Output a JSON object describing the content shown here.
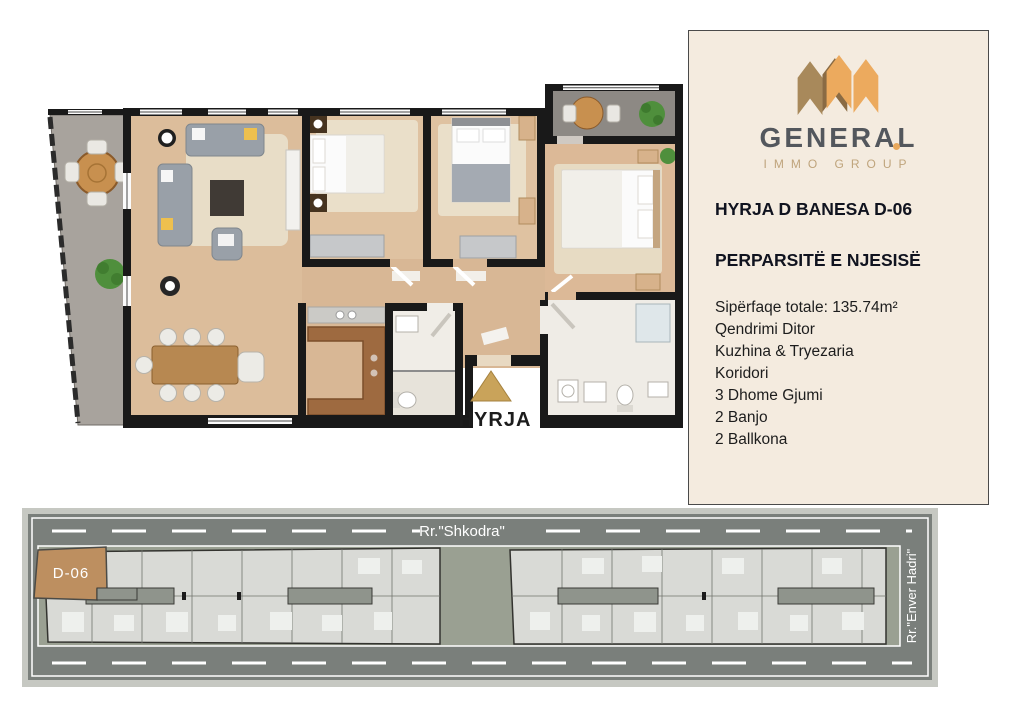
{
  "window": {
    "width": 1013,
    "height": 717,
    "background": "#ffffff"
  },
  "floor_plan": {
    "entrance_label": "HYRJA",
    "entrance_marker_color": "#c9a35a"
  },
  "sidebar": {
    "background": "#f4ebdf",
    "logo": {
      "brand": "GENERAL",
      "subtitle": "IMMO GROUP",
      "brand_color": "#53575d",
      "subtitle_color": "#bfa47c",
      "icon_orange": "#ecaa5e",
      "icon_tan": "#a8895b",
      "icon_dark_brown": "#8a6b44"
    },
    "title": "HYRJA D BANESA D-06",
    "section_title": "PERPARSITË E NJESISË",
    "details": [
      "Sipërfaqe totale: 135.74m²",
      "Qendrimi Ditor",
      "Kuzhina & Tryezaria",
      "Koridori",
      "3 Dhome Gjumi",
      "2 Banjo",
      "2 Ballkona"
    ]
  },
  "site_plan": {
    "street_top": "Rr.\"Shkodra\"",
    "street_right": "Rr.\"Enver Hadri\"",
    "highlighted_unit": "D-06",
    "unit_color": "#bd8f60",
    "road_color": "#7a7f7b",
    "yard_color": "#9aa092",
    "building_color": "#d9dad6"
  }
}
